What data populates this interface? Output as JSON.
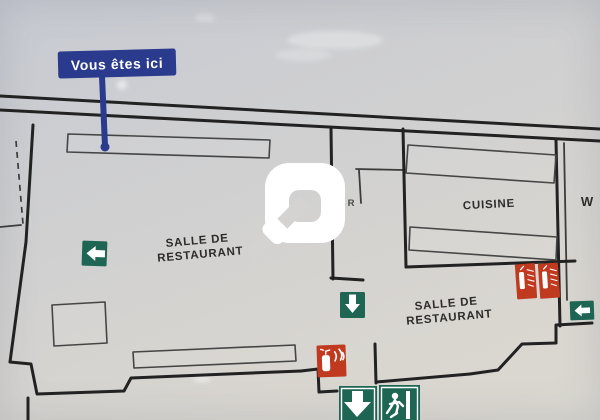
{
  "you_are_here": {
    "label": "Vous êtes ici"
  },
  "labels": {
    "salle_restaurant_1": {
      "line1": "SALLE DE",
      "line2": "RESTAURANT"
    },
    "cuisine": "CUISINE",
    "salle_restaurant_2": {
      "line1": "SALLE DE",
      "line2": "RESTAURANT"
    },
    "partial_room_w": "W",
    "partial_room_r": "R"
  },
  "icons": {
    "exit_arrow_left_main": "green square, white arrow pointing left",
    "exit_arrow_down_mid": "green square, white arrow pointing down",
    "exit_arrow_left_small": "green square, white arrow pointing left",
    "extinguisher_wall_sign_pair": "two red vertical extinguisher signs",
    "fire_extinguisher_flames": "red square with extinguisher and flames",
    "emergency_exit_bottom": "green exit sign: down arrow and running man",
    "watermark_logo": "white overlay logo"
  },
  "colors": {
    "background_top": "#c7cad2",
    "background_mid": "#d0d0d1",
    "background_bottom": "#d9d6d0",
    "paper": "#d4d3d1",
    "wall": "#222222",
    "thin": "#3c3c3c",
    "blue": "#2a3a8c",
    "green": "#1e6553",
    "red": "#c03a20",
    "text": "#2e2c2a",
    "white": "#ffffff"
  }
}
